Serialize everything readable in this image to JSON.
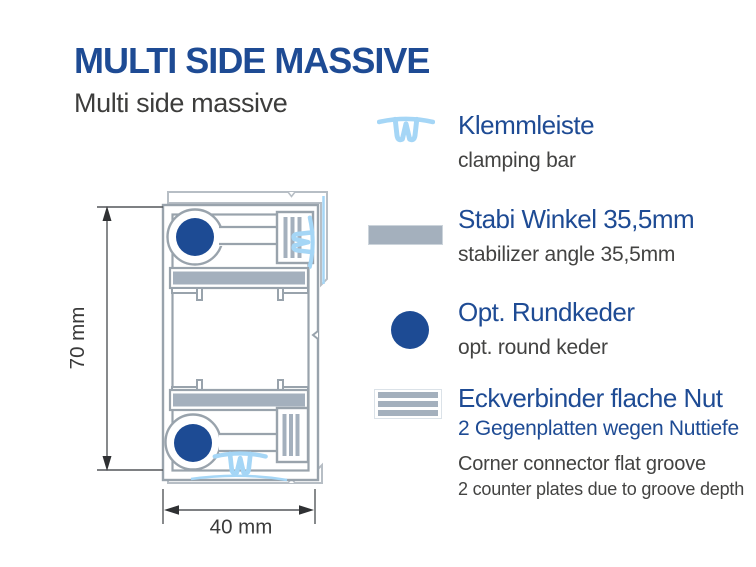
{
  "header": {
    "title": "MULTI SIDE MASSIVE",
    "subtitle": "Multi side massive"
  },
  "diagram": {
    "description": "profile cross-section",
    "dim_height_label": "70 mm",
    "dim_width_label": "40 mm"
  },
  "legend": {
    "items": [
      {
        "icon": "clamp-profile-icon",
        "title": "Klemmleiste",
        "subtitle": "clamping bar"
      },
      {
        "icon": "stabilizer-bar-icon",
        "title": "Stabi Winkel 35,5mm",
        "subtitle": "stabilizer angle 35,5mm"
      },
      {
        "icon": "round-keder-icon",
        "title": "Opt. Rundkeder",
        "subtitle": "opt. round keder"
      },
      {
        "icon": "corner-connector-icon",
        "title": "Eckverbinder flache Nut",
        "title_note_de": "2 Gegenplatten wegen Nuttiefe",
        "subtitle": "Corner connector flat groove",
        "subtitle2": "2 counter plates due to groove depth"
      }
    ]
  },
  "colors": {
    "accent_blue": "#1e4b94",
    "keder_blue": "#1d4b94",
    "light_blue": "#a5d6f6",
    "steel_gray": "#a4b0bd",
    "outline_gray": "#99a3ac",
    "text_gray": "#434342"
  }
}
